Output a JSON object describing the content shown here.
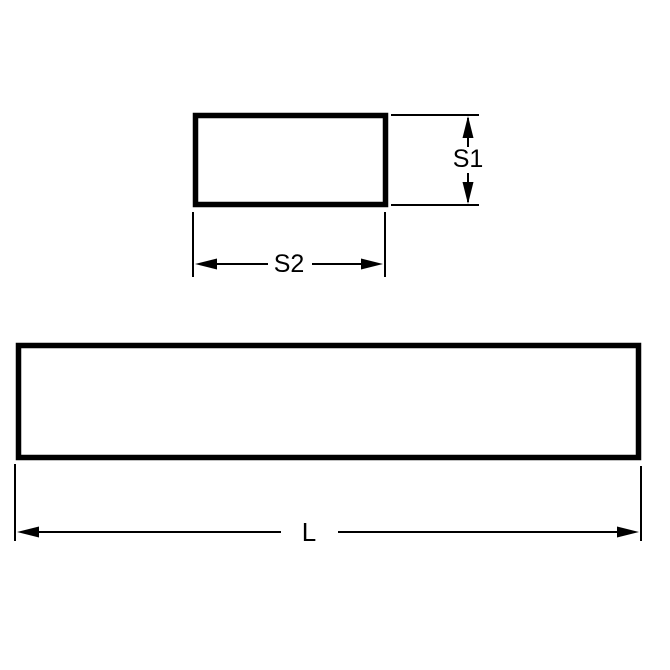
{
  "diagram": {
    "colors": {
      "line": "#000000",
      "background": "#ffffff"
    },
    "cross_section": {
      "height_label": "S1",
      "width_label": "S2"
    },
    "side_view": {
      "length_label": "L"
    }
  }
}
